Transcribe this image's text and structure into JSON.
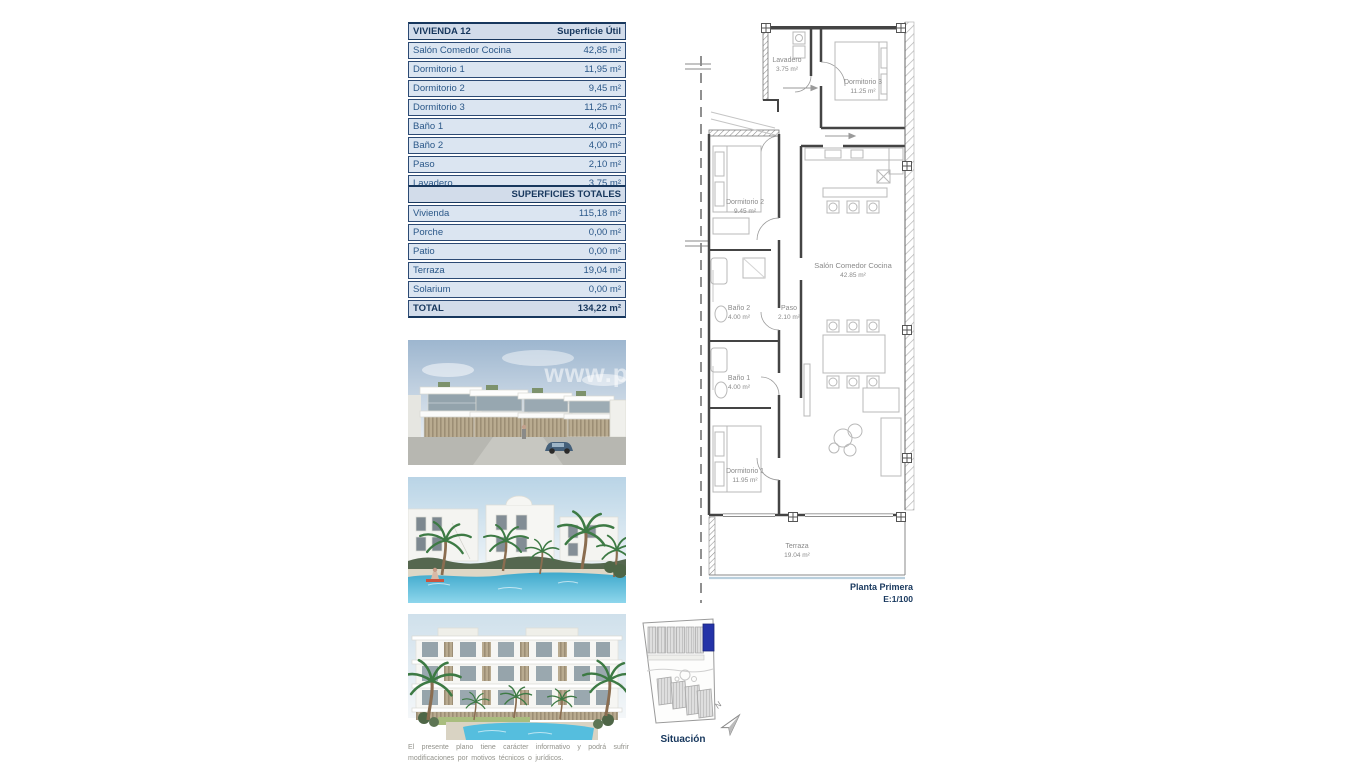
{
  "vivienda_table": {
    "title": "VIVIENDA 12",
    "header_right": "Superficie Útil",
    "rows": [
      {
        "label": "Salón Comedor Cocina",
        "value": "42,85 m²"
      },
      {
        "label": "Dormitorio 1",
        "value": "11,95 m²"
      },
      {
        "label": "Dormitorio 2",
        "value": "9,45 m²"
      },
      {
        "label": "Dormitorio 3",
        "value": "11,25 m²"
      },
      {
        "label": "Baño 1",
        "value": "4,00 m²"
      },
      {
        "label": "Baño 2",
        "value": "4,00 m²"
      },
      {
        "label": "Paso",
        "value": "2,10 m²"
      },
      {
        "label": "Lavadero",
        "value": "3,75 m²"
      }
    ]
  },
  "totales_table": {
    "title": "SUPERFICIES TOTALES",
    "rows": [
      {
        "label": "Vivienda",
        "value": "115,18 m²"
      },
      {
        "label": "Porche",
        "value": "0,00 m²"
      },
      {
        "label": "Patio",
        "value": "0,00 m²"
      },
      {
        "label": "Terraza",
        "value": "19,04 m²"
      },
      {
        "label": "Solarium",
        "value": "0,00 m²"
      }
    ],
    "total": {
      "label": "TOTAL",
      "value": "134,22 m²"
    }
  },
  "floorplan": {
    "rooms": [
      {
        "name": "Lavadero",
        "area": "3.75 m²"
      },
      {
        "name": "Dormitorio 3",
        "area": "11.25 m²"
      },
      {
        "name": "Dormitorio 2",
        "area": "9.45 m²"
      },
      {
        "name": "Salón Comedor Cocina",
        "area": "42.85 m²"
      },
      {
        "name": "Baño 2",
        "area": "4.00 m²"
      },
      {
        "name": "Paso",
        "area": "2.10 m²"
      },
      {
        "name": "Baño 1",
        "area": "4.00 m²"
      },
      {
        "name": "Dormitorio 1",
        "area": "11.95 m²"
      },
      {
        "name": "Terraza",
        "area": "19.04 m²"
      }
    ],
    "caption": {
      "line1": "Planta Primera",
      "line2": "E:1/100"
    }
  },
  "site_plan": {
    "label": "Situación",
    "north_label": "N"
  },
  "photos": {
    "watermark": "www.p"
  },
  "disclaimer": "El presente plano tiene carácter informativo y podrá sufrir modificaciones por motivos técnicos o jurídicos.",
  "colors": {
    "accent_blue": "#17375d",
    "row_text": "#2a5788",
    "row_bg": "#dbe5f1",
    "header_bg": "#d2dcea",
    "highlighted_unit": "#2433a8"
  }
}
